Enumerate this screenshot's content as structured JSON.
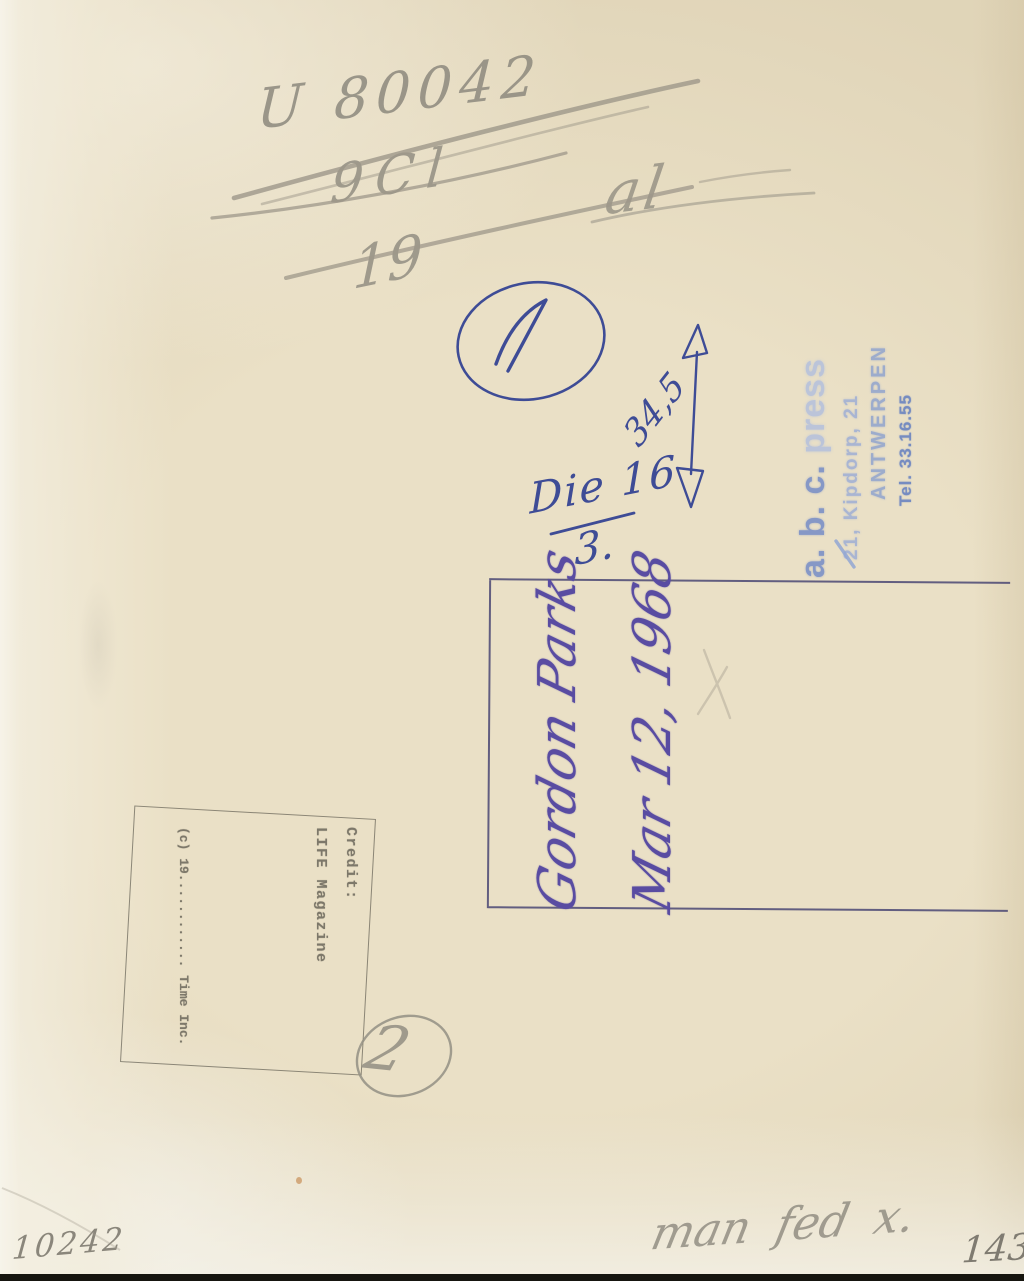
{
  "artifact": {
    "description_label": "photograph verso with handwritten annotations and stamps"
  },
  "colors": {
    "paper": "#eae0c6",
    "pencil": "#8d897e",
    "blue_ink": "#3e4c96",
    "violet_ink": "#5a4da2",
    "stamp_blue": "#6e87c6",
    "stamp_grey": "#6f6a5e",
    "box_border": "#403d6e"
  },
  "pencil": {
    "code_top": "U 80042",
    "crossed_value": "9Cl",
    "under_value": "19",
    "scribble": "al",
    "circled_number_bottom": "2",
    "serial_bottom_left": "10242",
    "note_bottom_right": "man fed x.",
    "number_bottom_right": "1430"
  },
  "blue_ink": {
    "circled_number_top": "1",
    "height_measurement": "34,5",
    "date_note_numerator": "Die 16",
    "date_note_denominator": "3."
  },
  "signature_stamp": {
    "name": "Gordon Parks",
    "date": "Mar 12, 1968"
  },
  "agency_stamp": {
    "line1_prefix": "a. b. c.",
    "line1_name": " press",
    "line2": "21, Kipdorp, 21",
    "line3": "ANTWERPEN",
    "line4": "Tel. 33.16.55"
  },
  "credit_stamp": {
    "line1": "Credit:",
    "line2": "LIFE Magazine",
    "line3": "(c) 19............ Time Inc."
  }
}
